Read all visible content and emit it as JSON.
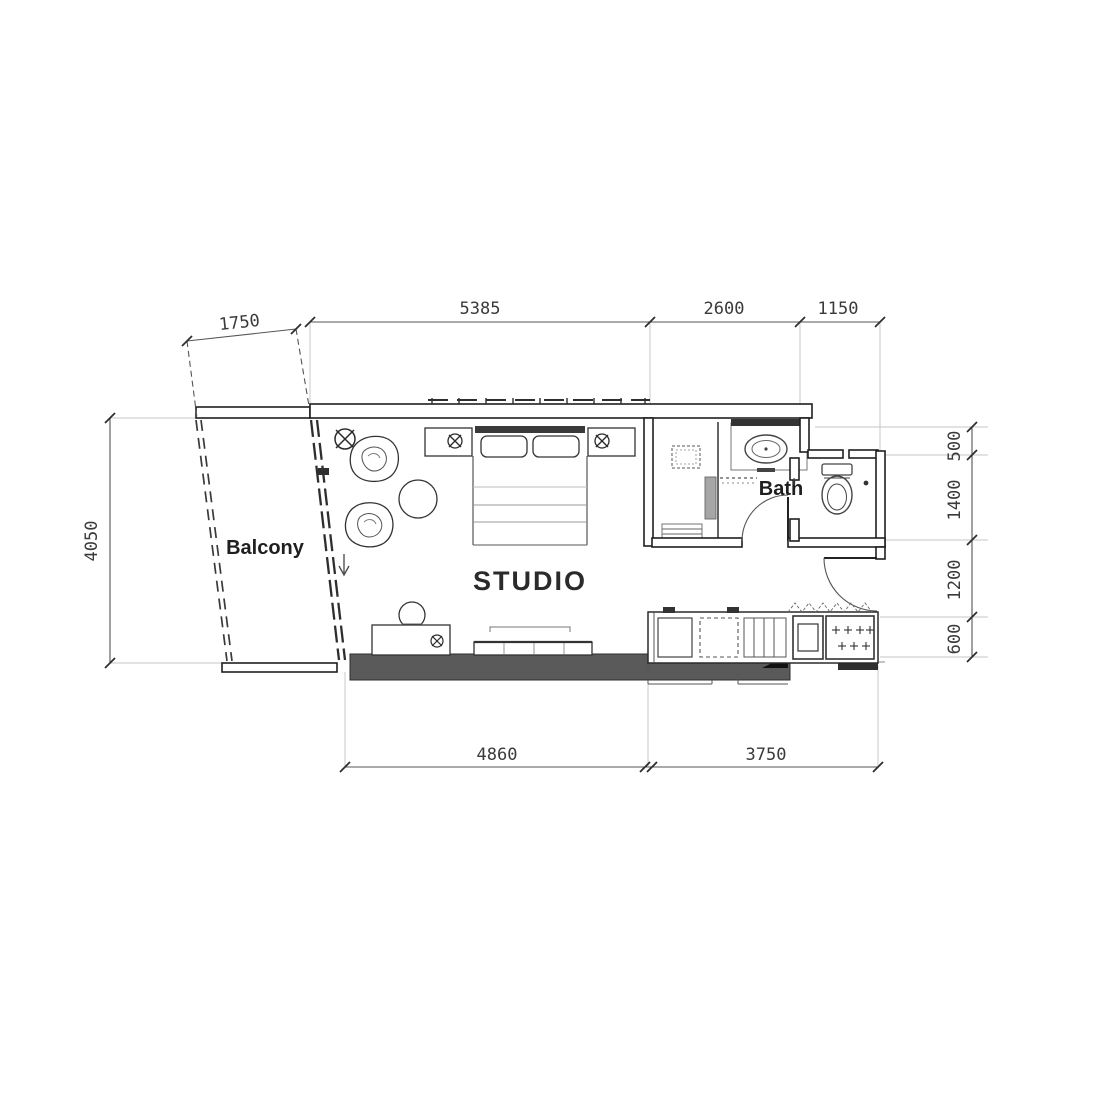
{
  "title": "Studio apartment floor plan",
  "labels": {
    "studio": "STUDIO",
    "balcony": "Balcony",
    "bath": "Bath"
  },
  "dimensions": {
    "top": [
      "1750",
      "5385",
      "2600",
      "1150"
    ],
    "left": [
      "4050"
    ],
    "right": [
      "500",
      "1400",
      "1200",
      "600"
    ],
    "bottom": [
      "4860",
      "3750"
    ]
  },
  "colors": {
    "wall_line": "#1f1f1f",
    "dark_wall_fill": "#5a5a5a",
    "extension_line": "#c4c4c4",
    "dimension_text": "#3a3a3a"
  }
}
